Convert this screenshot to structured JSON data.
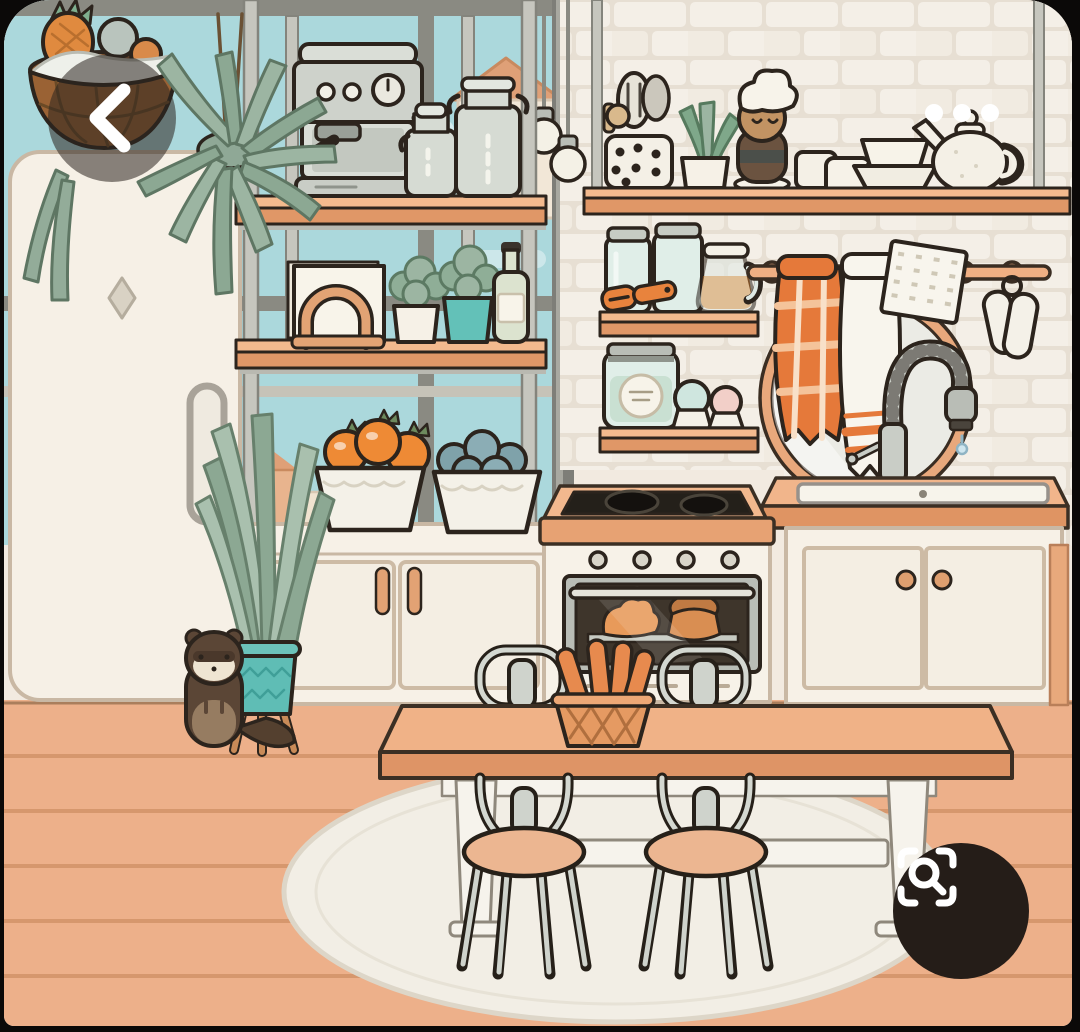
{
  "app": {
    "view": "image-viewer"
  },
  "ui": {
    "back_button": {
      "icon": "chevron-left-icon",
      "shape": "translucent-dark-circle"
    },
    "more_options_button": {
      "icon": "ellipsis-icon",
      "dot_count": 3
    },
    "lens_search_button": {
      "icon": "camera-search-icon",
      "shape": "dark-circle"
    }
  },
  "scene": {
    "style": "toca-life-cartoon-kitchen",
    "items": [
      "hanging fruit basket",
      "hanging fern",
      "refrigerator",
      "espresso machine",
      "milk canisters",
      "metal shelving unit",
      "napkin holder",
      "potted herb white pot",
      "potted herb teal pot",
      "oil bottle",
      "bowl of oranges",
      "bowl of blueberries",
      "storage cabinet",
      "glass jars",
      "vegetable peeler",
      "juice pitcher",
      "labeled storage jar",
      "salt shaker",
      "pepper shaker",
      "utensil crock",
      "shelf plant",
      "chef figurine",
      "mugs",
      "stacked bowls",
      "teapot",
      "towel rail",
      "orange plaid towel",
      "white towel",
      "waffle cloth",
      "oven mitts",
      "round mirror",
      "gooseneck faucet",
      "kitchen sink",
      "sink cabinet",
      "two-burner cooktop",
      "oven with croissant and pie",
      "snake plant in teal pot",
      "pet ferret",
      "dining table",
      "bread basket with baguettes",
      "metal cafe chairs",
      "round area rug",
      "plank floor",
      "window with houses",
      "white brick wall",
      "pendant light bulbs"
    ]
  },
  "colors": {
    "sky": "#abd8dc",
    "wall": "#f2eae0",
    "brick": "#f4efe7",
    "brick_mortar": "#e7dfd3",
    "floor": "#edb08a",
    "floor_line": "#d6976d",
    "wood": "#f0b287",
    "wood_dark": "#de9466",
    "outline": "#2c241d",
    "fridge": "#f6f0e6",
    "rug": "#f2eee5",
    "teal": "#5fbdb5",
    "sage": "#9cb5a2",
    "orange": "#ee8a35",
    "towel_orange": "#e5793a",
    "metal": "#d7dbd4",
    "ui_scrim": "rgba(43,36,31,0.55)",
    "ui_dark": "#251d18",
    "white": "#ffffff"
  }
}
